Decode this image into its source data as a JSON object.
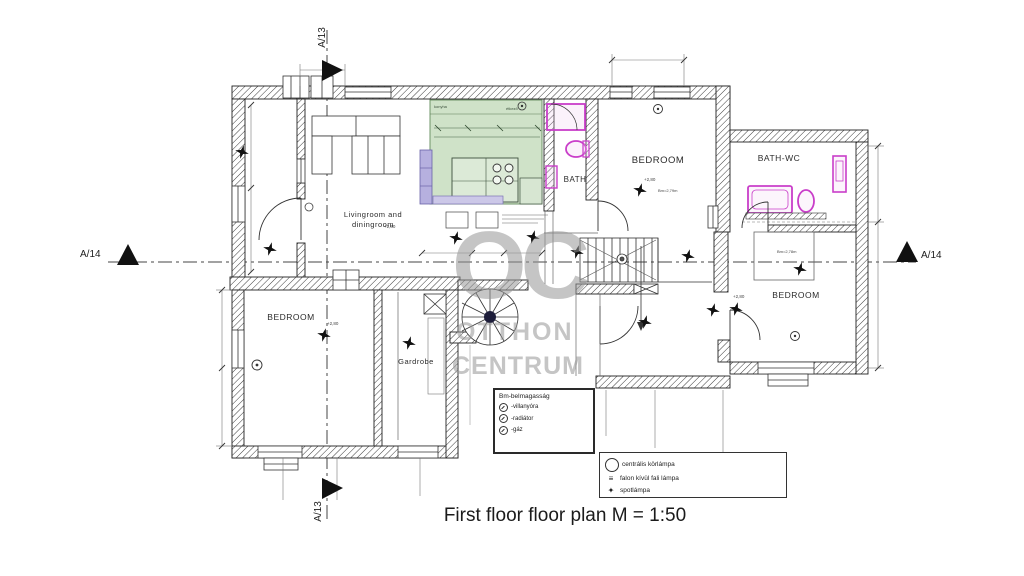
{
  "plan": {
    "title": "First floor floor plan M = 1:50",
    "watermark": {
      "top": "OC",
      "middle": "OTTHON",
      "bottom": "CENTRUM"
    },
    "markers": {
      "top": "A/13",
      "bottom": "A/13",
      "left": "A/14",
      "right": "A/14"
    },
    "rooms": {
      "livingroom_line1": "Livingroom and",
      "livingroom_line2": "diningroom",
      "kitchen": "konyha",
      "dining": "étkező",
      "bath": "BATH",
      "bedroom_top": "BEDROOM",
      "bath_wc": "BATH-WC",
      "bedroom_right": "BEDROOM",
      "bedroom_left": "BEDROOM",
      "gardrobe": "Gardrobe"
    },
    "annotations": {
      "level_livingroom": "+2,80",
      "level_bedroom_top": "+2,80",
      "height_bedroom_top": "Bm=2,79m",
      "level_bedroom_right": "+2,80",
      "height_bedroom_right": "Bm=2,78m",
      "level_bedroom_left": "+2,80"
    },
    "legend_heights": {
      "title": "Bm-belmagasság",
      "items": [
        {
          "label": "-villanyóra"
        },
        {
          "label": "-radiátor"
        },
        {
          "label": "-gáz"
        }
      ]
    },
    "legend_lamps": {
      "items": [
        {
          "label": "centrális körlámpa"
        },
        {
          "label": "falon kívül fali lámpa"
        },
        {
          "label": "spotlámpa"
        }
      ],
      "icons": {
        "wall_lamp": "≡",
        "spot": "✦"
      }
    },
    "colors": {
      "kitchen_fill": "#cfe2c8",
      "cabinet_fill": "#b6b0df",
      "fixture_stroke": "#c93ec9",
      "watermark": "#9c9c9c",
      "wall_line": "#222222"
    }
  }
}
